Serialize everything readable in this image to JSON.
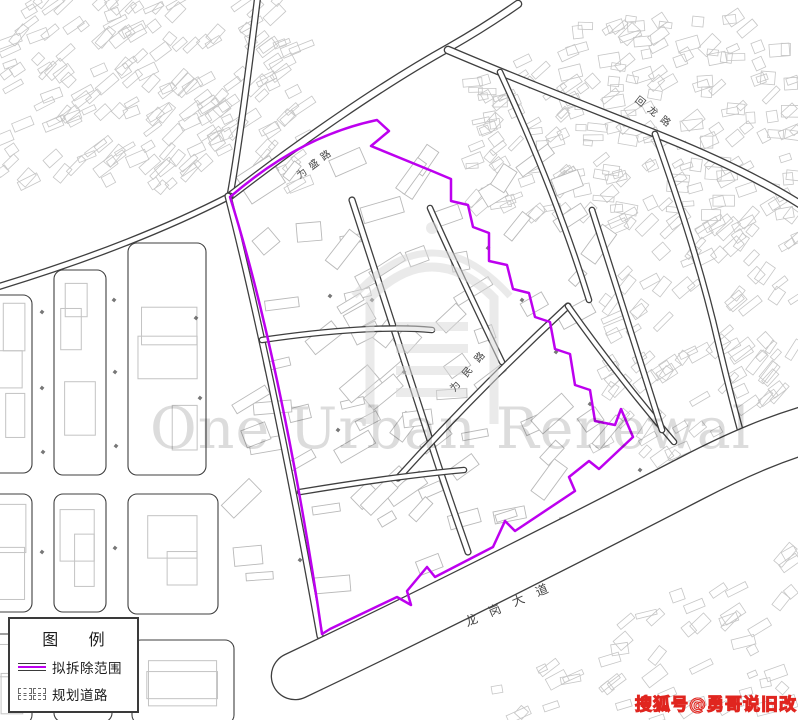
{
  "map": {
    "watermark_text": "One Urban Renewal",
    "badge_text": "搜狐号@勇哥说旧改",
    "emblem_icon": "archway-gate-emblem",
    "road_labels": {
      "weisheng": "为盛路",
      "huilong": "回龙路",
      "weimin": "为民路",
      "longgang_avenue": "龙岗大道"
    },
    "colors": {
      "boundary": "#bd00ef",
      "road_line": "#3f3f3f",
      "building_line": "#c6c6c6",
      "watermark": "#dcdcdc",
      "badge": "#e0251f"
    }
  },
  "legend": {
    "title": "图例",
    "items": [
      {
        "symbol": "demolition-boundary-line",
        "label": "拟拆除范围"
      },
      {
        "symbol": "planned-road",
        "label": "规划道路"
      }
    ]
  }
}
